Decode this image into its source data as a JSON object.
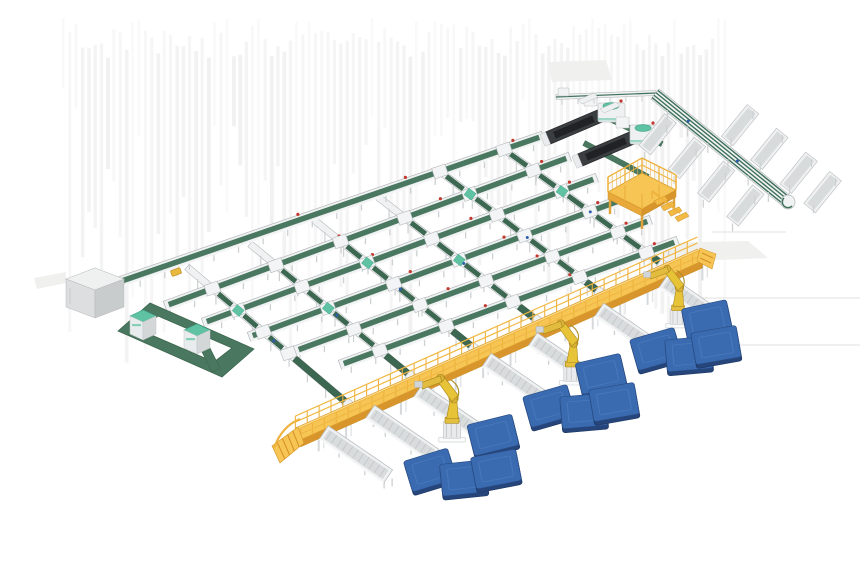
{
  "scene": {
    "description": "3D isometric render of an automated parcel sorting and palletizing line: cross-belt sorter grid, telescopic boom unloaders, recirculation lane with discharge trays, operator mezzanine platform, elevated yellow maintenance walkway with stair ramps, robotic palletizer arms, outfeed roller spurs and blue floor pallets",
    "canvas": {
      "w": 860,
      "h": 580,
      "bg": "#ffffff"
    },
    "palette": {
      "beltGreen": "#49775f",
      "beltGreenDark": "#3c6750",
      "beltGreenLine": "#3e705a",
      "frameWhite": "#eff1f2",
      "frameEdge": "#b4b8ba",
      "rollerGray": "#d9dcdd",
      "rollerLine": "#c4c7c9",
      "legGray": "#cdd0d2",
      "walkYellowTop": "#f7c553",
      "walkYellowFace": "#e8a93a",
      "walkYellowDeep": "#d8952c",
      "railYellow": "#eeb23e",
      "robotYellow": "#e7c337",
      "robotYellowDark": "#a8861d",
      "robotYellowMid": "#d9b237",
      "palletBlue": "#3a6bb0",
      "palletBlueSide": "#26457a",
      "palletHighlight": "#5585c6",
      "mintGreen": "#5fc3a3",
      "mintGreenDark": "#3fa487",
      "machineDark": "#3b3e41",
      "machineDarker": "#202224",
      "cabinetTop": "#eff1f1",
      "cabinetFront": "#dcdee0",
      "cabinetSide": "#c9cccd",
      "dotRed": "#c4392e",
      "dotBlue": "#2d5fae",
      "stripe": "#ebebeb",
      "artifact": "#dcdcdc",
      "shadow": "#f0f0ef"
    },
    "stripes": {
      "x0": 62,
      "dx": 6.3,
      "count": 106,
      "yTop": 18,
      "minH": 70,
      "maxH": 320,
      "opacity": 0.55
    },
    "artifact_lines": [
      [
        702,
        298,
        860,
        298
      ],
      [
        677,
        345,
        860,
        345
      ],
      [
        712,
        232,
        786,
        232
      ]
    ],
    "shadow_polys": [
      [
        [
          652,
          243
        ],
        [
          748,
          241
        ],
        [
          768,
          258
        ],
        [
          668,
          262
        ]
      ],
      [
        [
          548,
          62
        ],
        [
          606,
          60
        ],
        [
          612,
          80
        ],
        [
          552,
          82
        ]
      ],
      [
        [
          34,
          278
        ],
        [
          66,
          272
        ],
        [
          66,
          283
        ],
        [
          37,
          289
        ]
      ]
    ],
    "rows": [
      [
        543,
        136,
        113,
        284
      ],
      [
        570,
        157,
        165,
        306
      ],
      [
        597,
        178,
        203,
        323
      ],
      [
        624,
        199,
        249,
        337
      ],
      [
        651,
        220,
        295,
        351
      ],
      [
        678,
        241,
        340,
        365
      ]
    ],
    "cols": [
      [
        505,
        150,
        669,
        269
      ],
      [
        442,
        173,
        606,
        297
      ],
      [
        378,
        197,
        543,
        325
      ],
      [
        314,
        220,
        480,
        353
      ],
      [
        250,
        244,
        417,
        381
      ],
      [
        187,
        267,
        354,
        409
      ]
    ],
    "walkway": {
      "a": [
        298,
        434
      ],
      "b": [
        700,
        255
      ]
    },
    "spurs": [
      [
        0.055,
        78
      ],
      [
        0.17,
        78
      ],
      [
        0.29,
        80
      ],
      [
        0.46,
        80
      ],
      [
        0.575,
        80
      ],
      [
        0.74,
        78
      ],
      [
        0.9,
        70
      ]
    ],
    "robots": [
      {
        "x": 452,
        "y": 414,
        "s": 0.78
      },
      {
        "x": 572,
        "y": 358,
        "s": 0.75
      },
      {
        "x": 678,
        "y": 302,
        "s": 0.72
      }
    ],
    "pallets": [
      [
        493,
        435,
        -14
      ],
      [
        430,
        470,
        -17
      ],
      [
        464,
        478,
        -6
      ],
      [
        496,
        469,
        -11
      ],
      [
        601,
        374,
        -13
      ],
      [
        549,
        406,
        -16
      ],
      [
        584,
        411,
        -5
      ],
      [
        614,
        402,
        -10
      ],
      [
        707,
        320,
        -12
      ],
      [
        656,
        349,
        -16
      ],
      [
        689,
        354,
        -5
      ],
      [
        716,
        345,
        -10
      ]
    ],
    "ring": {
      "outer": [
        [
          118,
          331
        ],
        [
          150,
          303
        ],
        [
          254,
          349
        ],
        [
          222,
          377
        ]
      ],
      "inner": [
        [
          140,
          330
        ],
        [
          158,
          316
        ],
        [
          232,
          348
        ],
        [
          214,
          362
        ]
      ],
      "bar": [
        [
          196,
          330
        ],
        [
          216,
          370
        ]
      ],
      "machines": [
        [
          130,
          316
        ],
        [
          184,
          330
        ]
      ]
    },
    "cabinet": {
      "x": 66,
      "y": 268
    },
    "platform": {
      "cx": 642,
      "cy": 190
    },
    "loaders": [
      [
        600,
        116
      ],
      [
        632,
        138
      ]
    ],
    "lane": {
      "a": [
        655,
        94
      ],
      "b": [
        788,
        202
      ],
      "upper_t": [
        0.5,
        0.72,
        0.94,
        1.12
      ],
      "lower_t": [
        0.16,
        0.38,
        0.6,
        0.82
      ]
    },
    "top_rail": {
      "a": [
        556,
        97
      ],
      "b": [
        656,
        93
      ]
    },
    "connector_belts": [
      [
        584,
        143,
        648,
        177
      ],
      [
        604,
        116,
        662,
        144
      ]
    ],
    "mini_trays": [
      [
        578,
        100
      ],
      [
        600,
        109
      ]
    ],
    "yellow_box": [
      176,
      272
    ],
    "counts": {
      "main_lines": 6,
      "sorter_lanes": 6,
      "robot_arms": 3,
      "pallets": 12,
      "outfeed_spurs": 7,
      "discharge_trays": 8,
      "boom_unloaders": 2,
      "loop_machines": 2
    }
  }
}
